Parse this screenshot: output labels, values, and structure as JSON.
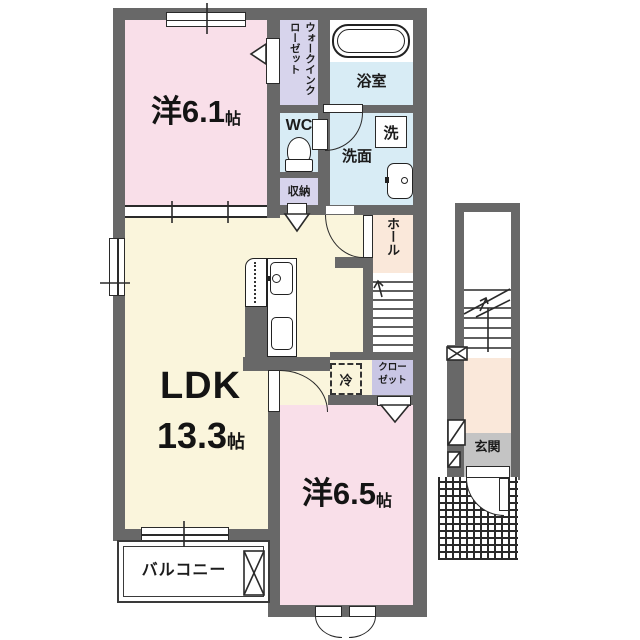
{
  "colors": {
    "wall": "#686868",
    "room-pink": "#f9dfe9",
    "room-cream": "#faf5dc",
    "room-blue": "#d8ecf5",
    "room-purple": "#d7d4ec",
    "closet-purple": "#c9c6e4",
    "hall-peach": "#fae8da",
    "genkan-gray": "#c4c4c4",
    "line": "#2a2a2a"
  },
  "fp": {
    "bedroom1_name": "洋6.1",
    "bedroom1_unit": "帖",
    "bedroom2_name": "洋6.5",
    "bedroom2_unit": "帖",
    "ldk_name": "LDK",
    "ldk_size": "13.3",
    "ldk_unit": "帖",
    "balcony": "バルコニー",
    "bath": "浴室",
    "washroom": "洗面",
    "washer": "洗",
    "wc": "WC",
    "storage": "収納",
    "wic_col1": "ウォークイン",
    "wic_col2": "クローゼット",
    "hall": "ホール",
    "closet_l1": "クロー",
    "closet_l2": "ゼット",
    "fridge": "冷",
    "entrance": "玄関"
  }
}
